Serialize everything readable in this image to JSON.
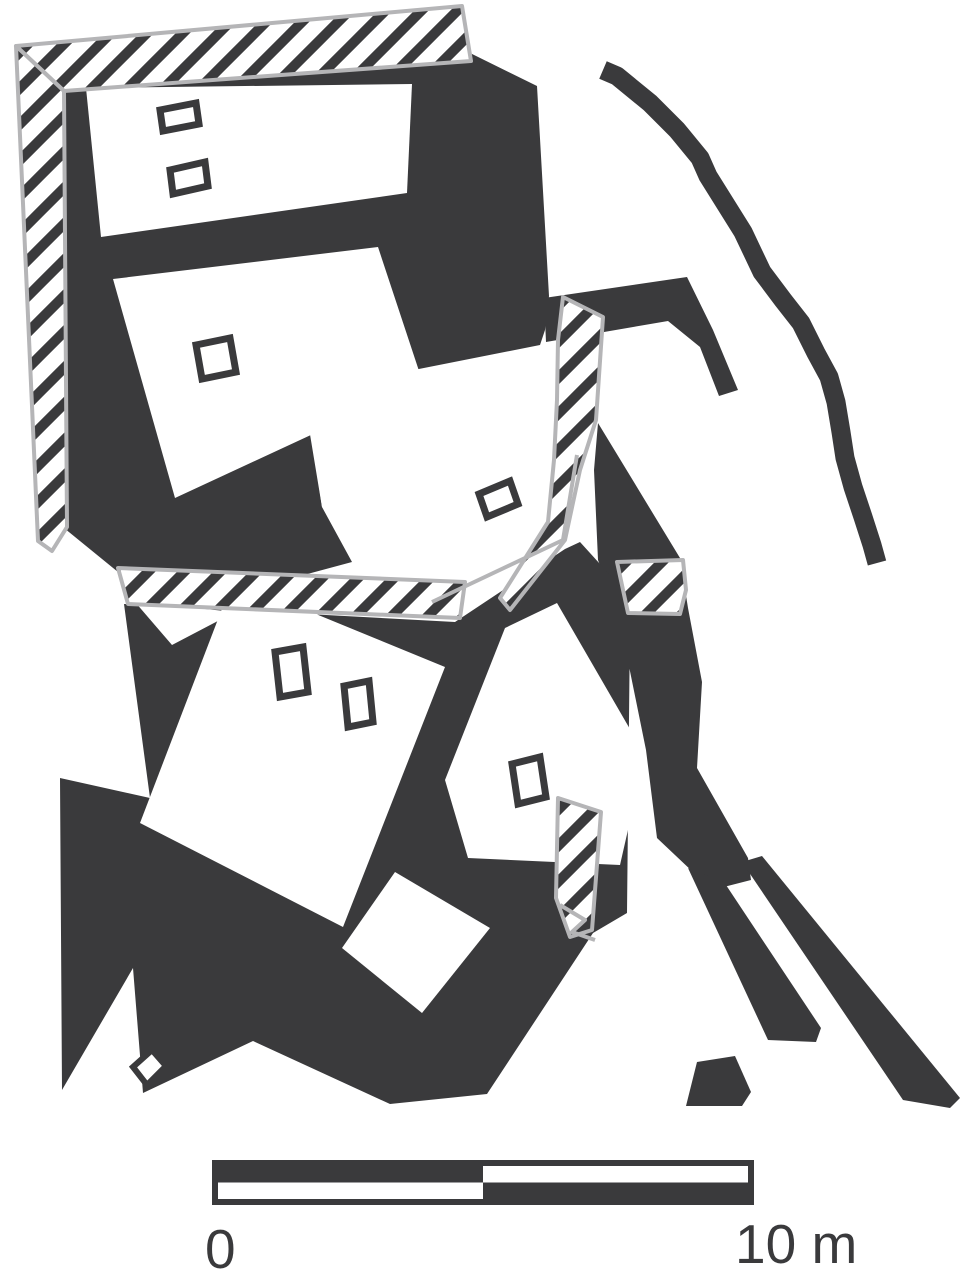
{
  "figure": {
    "type": "archaeological-site-plan",
    "description": "Plan of an excavated multi-room building complex drawn in black and white: solid dark wall masses, diagonally hatched bands along the north and west sides and between rooms, six white room interiors containing small rectangular features, a curved wall line at the upper right, detached wall tails at the lower right, and a metric scale bar below the plan."
  },
  "colors": {
    "wall": "#3a3a3c",
    "outline": "#b5b5b7",
    "background": "#ffffff",
    "text": "#3a3a3c"
  },
  "scale_bar": {
    "start_label": "0",
    "end_label": "10 m"
  },
  "elements": [
    "hatched-band-top",
    "hatched-band-left",
    "hatched-band-bottom",
    "hatched-band-middle",
    "hatched-patch-east",
    "hatched-patch-south",
    "upper-building-walls",
    "hook-wall-northeast",
    "curved-terrace-wall",
    "southeast-wall-spur",
    "lower-building-walls",
    "wall-tail-a",
    "wall-tail-b",
    "wall-fragment-south",
    "room-1",
    "room-2",
    "room-3",
    "room-4",
    "room-5",
    "room-6",
    "feature-rect-1",
    "feature-rect-2",
    "feature-rect-3",
    "feature-rect-4",
    "feature-rect-5",
    "feature-rect-6",
    "feature-rect-7",
    "feature-rect-8",
    "excavation-limit-line",
    "excavation-limit-zigzag",
    "scale-bar"
  ]
}
